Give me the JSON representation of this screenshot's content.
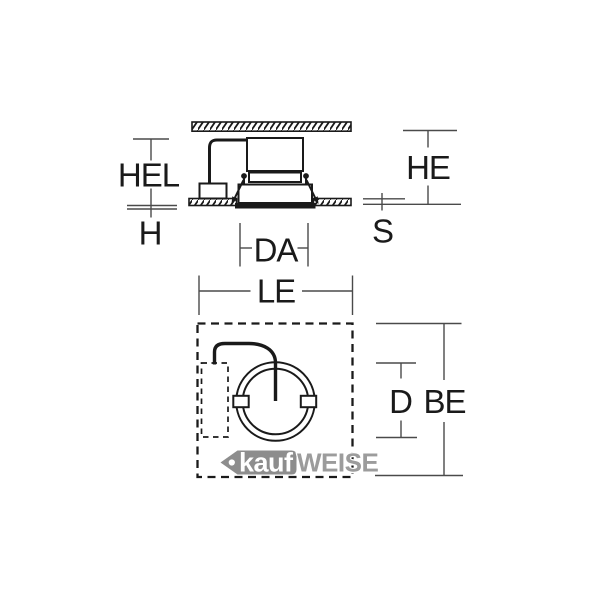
{
  "labels": {
    "hel": "HEL",
    "h": "H",
    "he": "HE",
    "s": "S",
    "da": "DA",
    "le": "LE",
    "d": "D",
    "be": "BE"
  },
  "watermark": {
    "prefix": "kauf",
    "suffix": "WEISE"
  },
  "icons": {
    "watermark_tag": "price-tag-icon"
  },
  "colors": {
    "background": "#ffffff",
    "line": "#1a1a1a",
    "dimension_line": "#4a4a4a",
    "watermark_tag": "#8d8d8d",
    "watermark_text": "#9c9c9c",
    "watermark_prefix_text": "#ffffff"
  }
}
